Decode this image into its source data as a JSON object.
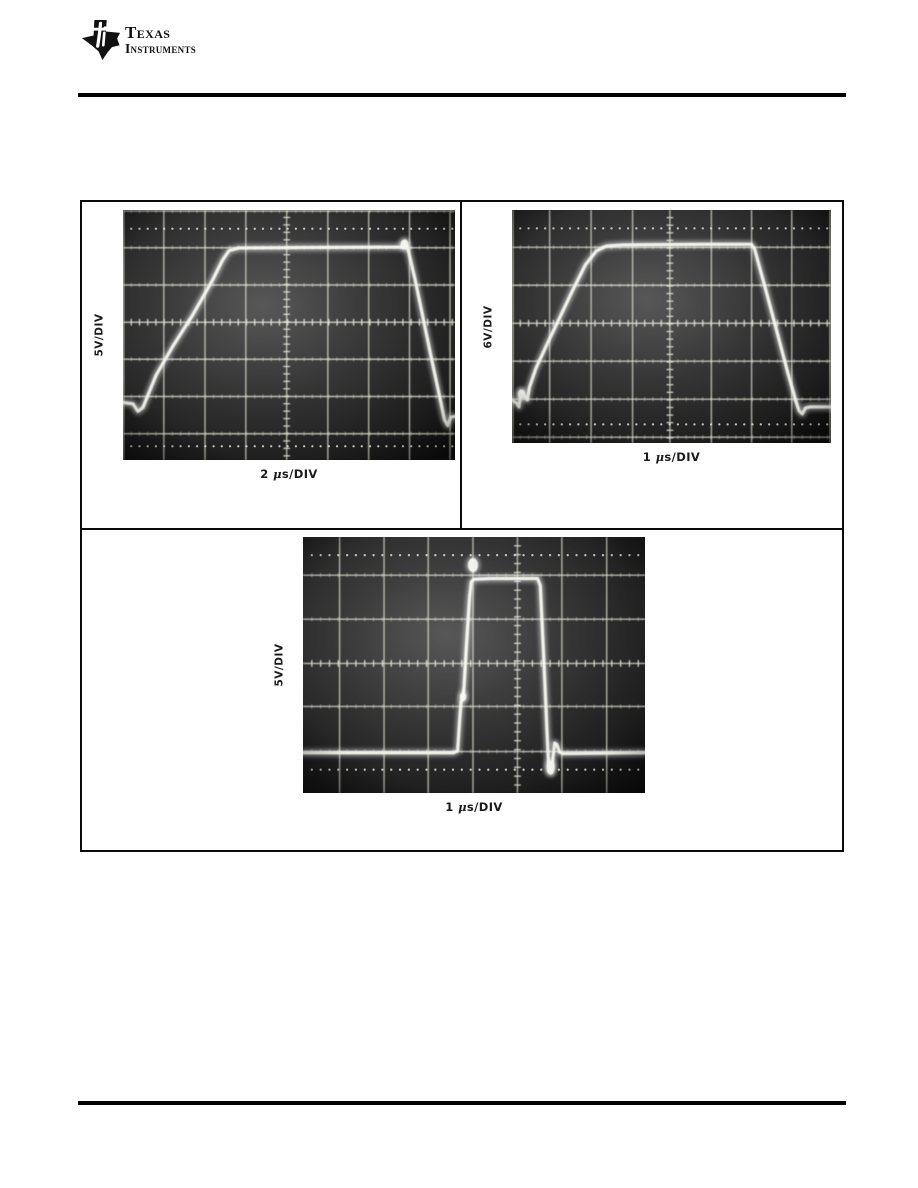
{
  "logo": {
    "line1": "Texas",
    "line2": "Instruments"
  },
  "chart_data": [
    {
      "type": "line",
      "name": "scope-photo-top-left",
      "y_label": "5V/DIV",
      "x_label": "2 μs/DIV",
      "volts_per_div": 5,
      "time_per_div_us": 2,
      "photo": {
        "x": 123,
        "y": 210,
        "w": 332,
        "h": 250
      },
      "grid": {
        "v": [
          0.002,
          0.123,
          0.247,
          0.37,
          0.493,
          0.617,
          0.74,
          0.863,
          0.985
        ],
        "h": [
          0.004,
          0.151,
          0.3,
          0.449,
          0.597,
          0.746,
          0.895
        ],
        "ticked_v": 0.493,
        "ticked_h": 0.449,
        "dotted_rows": [
          0.075,
          0.945
        ]
      },
      "waveform": [
        [
          0.0,
          0.77
        ],
        [
          0.03,
          0.775
        ],
        [
          0.045,
          0.805
        ],
        [
          0.06,
          0.79
        ],
        [
          0.1,
          0.66
        ],
        [
          0.15,
          0.545
        ],
        [
          0.21,
          0.42
        ],
        [
          0.27,
          0.28
        ],
        [
          0.3,
          0.2
        ],
        [
          0.32,
          0.162
        ],
        [
          0.35,
          0.152
        ],
        [
          0.55,
          0.15
        ],
        [
          0.84,
          0.148
        ],
        [
          0.85,
          0.132
        ],
        [
          0.858,
          0.155
        ],
        [
          0.88,
          0.28
        ],
        [
          0.905,
          0.44
        ],
        [
          0.93,
          0.6
        ],
        [
          0.955,
          0.755
        ],
        [
          0.968,
          0.838
        ],
        [
          0.978,
          0.862
        ],
        [
          0.988,
          0.828
        ],
        [
          1.0,
          0.826
        ]
      ],
      "blobs": [
        [
          0.848,
          0.138,
          4,
          5
        ]
      ]
    },
    {
      "type": "line",
      "name": "scope-photo-top-right",
      "y_label": "6V/DIV",
      "x_label": "1 μs/DIV",
      "volts_per_div": 6,
      "time_per_div_us": 1,
      "photo": {
        "x": 512,
        "y": 210,
        "w": 319,
        "h": 233
      },
      "grid": {
        "v": [
          0.003,
          0.118,
          0.248,
          0.378,
          0.495,
          0.625,
          0.751,
          0.877,
          0.997
        ],
        "h": [
          0.16,
          0.323,
          0.486,
          0.649,
          0.812,
          0.975
        ],
        "ticked_v": 0.495,
        "ticked_h": 0.486,
        "dotted_rows": [
          0.079,
          0.92
        ]
      },
      "waveform": [
        [
          0.0,
          0.815
        ],
        [
          0.015,
          0.83
        ],
        [
          0.022,
          0.845
        ],
        [
          0.028,
          0.78
        ],
        [
          0.035,
          0.79
        ],
        [
          0.048,
          0.815
        ],
        [
          0.055,
          0.76
        ],
        [
          0.075,
          0.68
        ],
        [
          0.11,
          0.575
        ],
        [
          0.15,
          0.46
        ],
        [
          0.19,
          0.345
        ],
        [
          0.23,
          0.235
        ],
        [
          0.265,
          0.175
        ],
        [
          0.295,
          0.155
        ],
        [
          0.35,
          0.15
        ],
        [
          0.6,
          0.147
        ],
        [
          0.75,
          0.147
        ],
        [
          0.76,
          0.165
        ],
        [
          0.795,
          0.34
        ],
        [
          0.83,
          0.52
        ],
        [
          0.865,
          0.7
        ],
        [
          0.89,
          0.82
        ],
        [
          0.9,
          0.862
        ],
        [
          0.91,
          0.875
        ],
        [
          0.92,
          0.85
        ],
        [
          0.935,
          0.845
        ],
        [
          1.0,
          0.845
        ]
      ],
      "blobs": [
        [
          0.03,
          0.79,
          3.5,
          4.5
        ]
      ]
    },
    {
      "type": "line",
      "name": "scope-photo-bottom-center",
      "y_label": "5V/DIV",
      "x_label": "1 μs/DIV",
      "volts_per_div": 5,
      "time_per_div_us": 1,
      "photo": {
        "x": 303,
        "y": 537,
        "w": 342,
        "h": 256
      },
      "grid": {
        "v": [
          0.107,
          0.237,
          0.366,
          0.497,
          0.627,
          0.757,
          0.888
        ],
        "h": [
          0.149,
          0.321,
          0.494,
          0.662,
          0.838
        ],
        "ticked_v": 0.627,
        "ticked_h": 0.494,
        "dotted_rows": [
          0.071,
          0.909
        ]
      },
      "waveform": [
        [
          0.0,
          0.843
        ],
        [
          0.44,
          0.843
        ],
        [
          0.452,
          0.835
        ],
        [
          0.458,
          0.72
        ],
        [
          0.462,
          0.645
        ],
        [
          0.468,
          0.625
        ],
        [
          0.471,
          0.58
        ],
        [
          0.478,
          0.42
        ],
        [
          0.487,
          0.235
        ],
        [
          0.492,
          0.175
        ],
        [
          0.5,
          0.165
        ],
        [
          0.55,
          0.162
        ],
        [
          0.686,
          0.162
        ],
        [
          0.694,
          0.19
        ],
        [
          0.702,
          0.42
        ],
        [
          0.71,
          0.65
        ],
        [
          0.716,
          0.84
        ],
        [
          0.72,
          0.915
        ],
        [
          0.726,
          0.92
        ],
        [
          0.731,
          0.86
        ],
        [
          0.736,
          0.805
        ],
        [
          0.742,
          0.81
        ],
        [
          0.75,
          0.84
        ],
        [
          0.76,
          0.846
        ],
        [
          1.0,
          0.843
        ]
      ],
      "blobs": [
        [
          0.497,
          0.11,
          5,
          7
        ],
        [
          0.724,
          0.9,
          4,
          7
        ],
        [
          0.468,
          0.624,
          3,
          4
        ]
      ]
    }
  ]
}
